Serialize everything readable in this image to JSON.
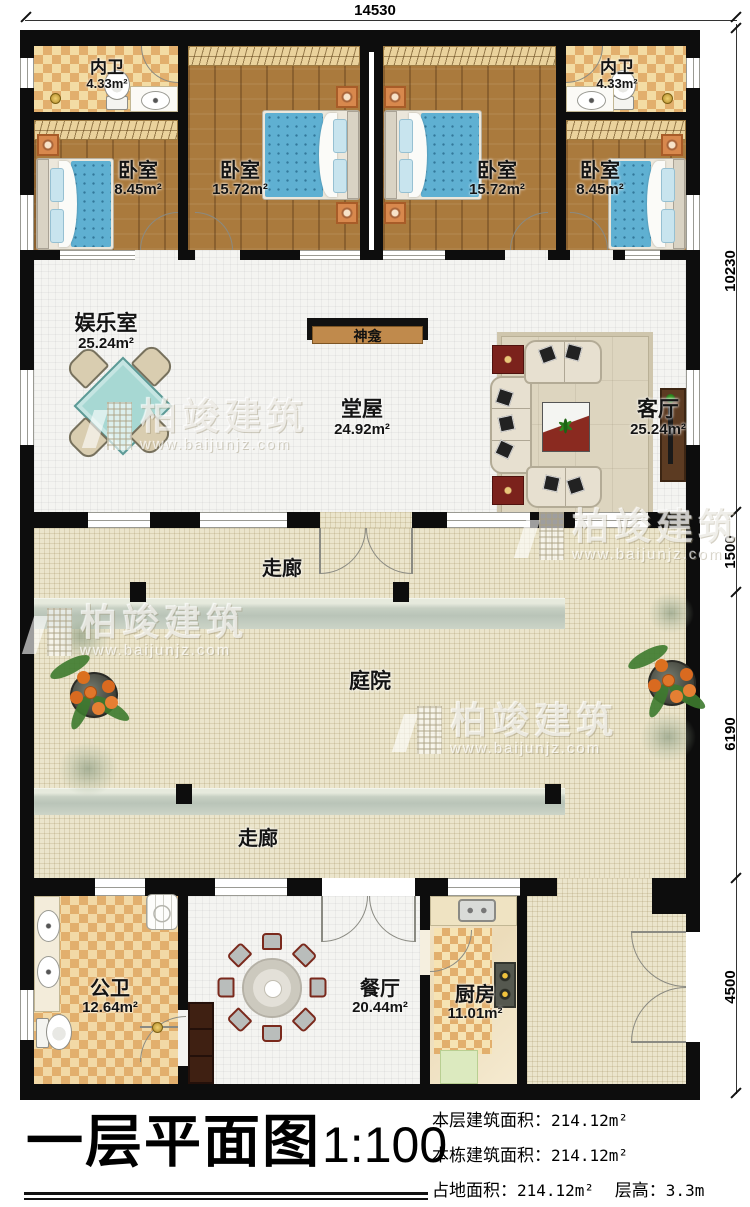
{
  "dimensions": {
    "top": "14530",
    "right_top": "10230",
    "right_corridor": "1500",
    "right_courtyard": "6190",
    "right_bottom": "4500"
  },
  "rooms": {
    "bath_top_left": {
      "name": "内卫",
      "area": "4.33m²"
    },
    "bedroom_left_small": {
      "name": "卧室",
      "area": "8.45m²"
    },
    "bedroom_left_large": {
      "name": "卧室",
      "area": "15.72m²"
    },
    "bedroom_right_large": {
      "name": "卧室",
      "area": "15.72m²"
    },
    "bath_top_right": {
      "name": "内卫",
      "area": "4.33m²"
    },
    "bedroom_right_small": {
      "name": "卧室",
      "area": "8.45m²"
    },
    "recreation": {
      "name": "娱乐室",
      "area": "25.24m²"
    },
    "shrine": {
      "name": "神龛"
    },
    "hall": {
      "name": "堂屋",
      "area": "24.92m²"
    },
    "living": {
      "name": "客厅",
      "area": "25.24m²"
    },
    "corridor_upper": {
      "name": "走廊"
    },
    "courtyard": {
      "name": "庭院"
    },
    "corridor_lower": {
      "name": "走廊"
    },
    "bath_public": {
      "name": "公卫",
      "area": "12.64m²"
    },
    "dining": {
      "name": "餐厅",
      "area": "20.44m²"
    },
    "kitchen": {
      "name": "厨房",
      "area": "11.01m²"
    }
  },
  "title_block": {
    "title": "一层平面图",
    "scale": "1:100",
    "line1_label": "本层建筑面积：",
    "line1_value": "214.12m²",
    "line2_label": "本栋建筑面积：",
    "line2_value": "214.12m²",
    "line3_label": "占地面积：",
    "line3_value": "214.12m²",
    "line3_label2": "层高：",
    "line3_value2": "3.3m"
  },
  "watermark": {
    "brand": "柏竣建筑",
    "url": "www.baijunjz.com"
  },
  "colors": {
    "wall": "#0d0d0d",
    "wood": "#aa7a3d",
    "bed": "#5fb0d2",
    "cream": "#ebe5cc",
    "accent_red": "#7b221c"
  }
}
